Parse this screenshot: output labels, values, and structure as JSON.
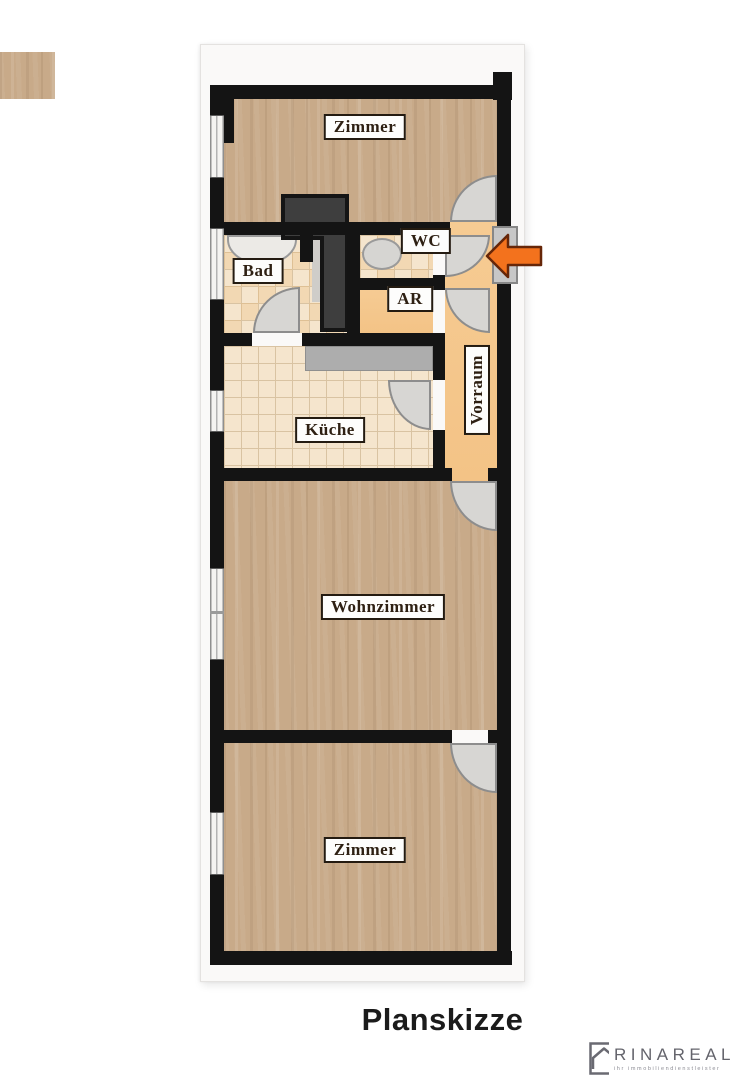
{
  "plan": {
    "rooms": {
      "zimmer_top": {
        "label": "Zimmer"
      },
      "bad": {
        "label": "Bad"
      },
      "wc": {
        "label": "WC"
      },
      "ar": {
        "label": "AR"
      },
      "kueche": {
        "label": "Küche"
      },
      "vorraum": {
        "label": "Vorraum"
      },
      "wohnzimmer": {
        "label": "Wohnzimmer"
      },
      "zimmer_bottom": {
        "label": "Zimmer"
      }
    },
    "caption": "Planskizze"
  },
  "logo": {
    "name": "RINAREAL",
    "tagline": "ihr immobiliendienstleister"
  },
  "colors": {
    "wall": "#141414",
    "wood_floor": "#c8aa89",
    "tile_floor": "#f5e5cd",
    "hall_floor": "#f5c88f",
    "shaft": "#3e3e3e",
    "arrow": "#f3721d",
    "door": "#d7d6d3"
  }
}
